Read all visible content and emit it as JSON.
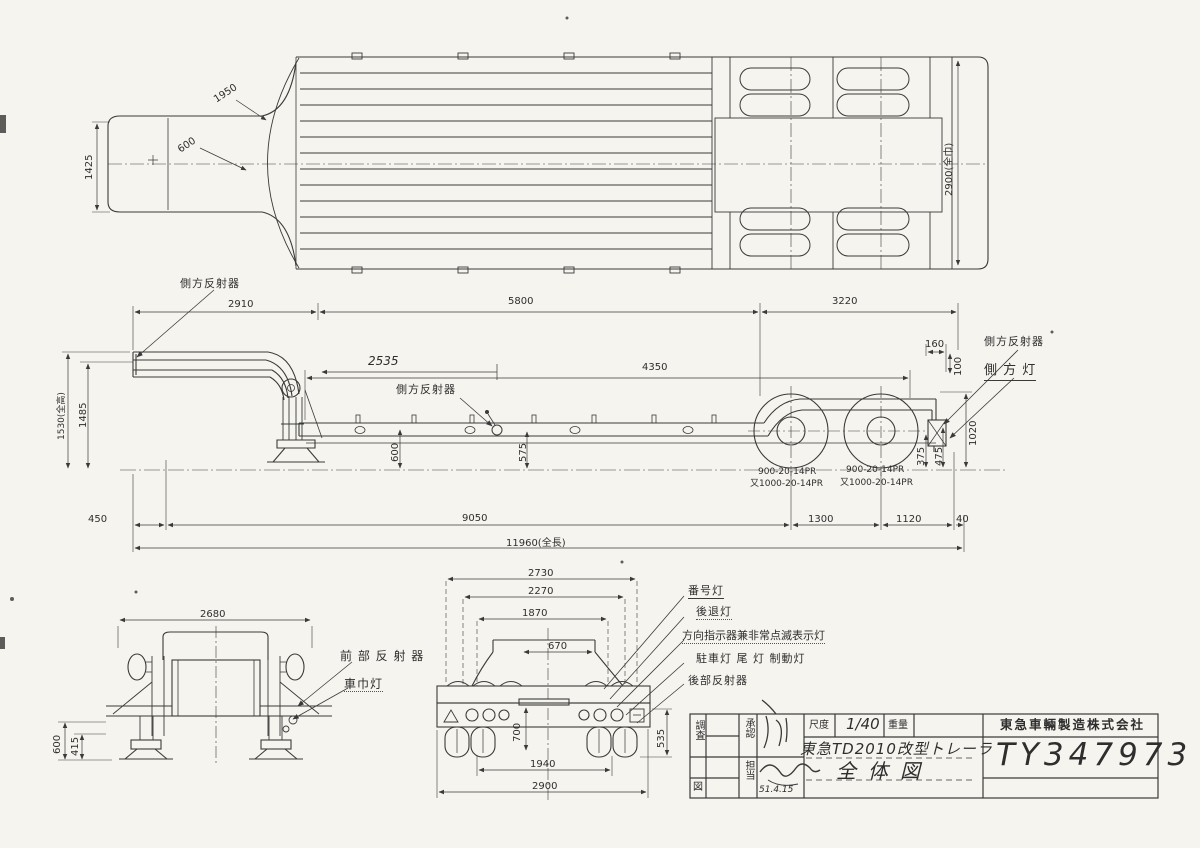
{
  "page": {
    "paper_color": "#f5f4ef",
    "ink_color": "#3a3a3a"
  },
  "dims": {
    "plan_1950": "1950",
    "plan_600": "600",
    "plan_1425": "1425",
    "plan_width": "2900(全巾)",
    "side_2910": "2910",
    "side_5800": "5800",
    "side_3220": "3220",
    "side_2535": "2535",
    "side_4350": "4350",
    "side_160": "160",
    "side_100": "100",
    "side_height": "1530(全高)",
    "side_1485": "1485",
    "side_600": "600",
    "side_575": "575",
    "side_1020": "1020",
    "side_375": "375",
    "side_475": "475",
    "side_450": "450",
    "side_9050": "9050",
    "side_1300": "1300",
    "side_1120": "1120",
    "side_40": "40",
    "side_total": "11960(全長)",
    "front_2680": "2680",
    "front_600": "600",
    "front_415": "415",
    "rear_2730": "2730",
    "rear_2270": "2270",
    "rear_1870": "1870",
    "rear_670": "670",
    "rear_700": "700",
    "rear_1940": "1940",
    "rear_2900": "2900",
    "rear_535": "535"
  },
  "tires": {
    "size_main": "900-20-14PR",
    "size_alt": "又1000-20-14PR"
  },
  "part_labels": {
    "side_reflector": "側方反射器",
    "side_lamp": "側 方 灯",
    "license_plate_lamp": "番号灯",
    "reverse_lamp": "後退灯",
    "turn_signal_lamp": "方向指示器兼非常点滅表示灯",
    "parking_tail_brake_lamp": "駐車灯 尾 灯 制動灯",
    "rear_reflector": "後部反射器",
    "front_reflector": "前 部 反 射 器",
    "clearance_lamp": "車巾灯"
  },
  "title_block": {
    "survey": "調査",
    "drawing_cell": "図",
    "approval": "承認",
    "charge": "担当",
    "date": "51.4.15",
    "scale_label": "尺度",
    "scale_value": "1/40",
    "weight_label": "重量",
    "weight_value": "",
    "product_title": "東急TD2010改型トレーラ",
    "drawing_title": "全体図",
    "company": "東急車輛製造株式会社",
    "drawing_number": "TY347973"
  }
}
